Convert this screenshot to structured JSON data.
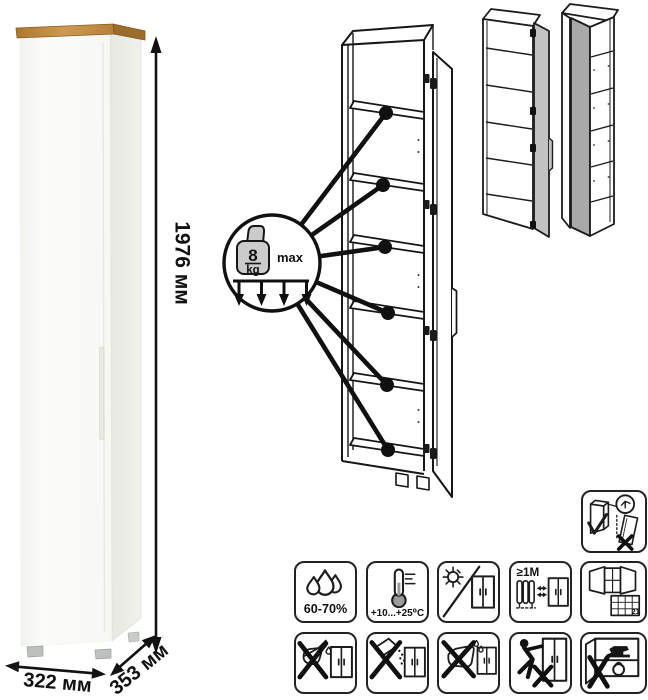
{
  "product": {
    "type": "tall one-door cabinet, white with wood top",
    "dimensions": {
      "height": "1976 мм",
      "width": "322 мм",
      "depth": "353 мм"
    }
  },
  "load_badge": {
    "value": "8",
    "unit": "kg",
    "max_label": "max",
    "shelf_count": 6
  },
  "care": {
    "humidity_label": "60-70%",
    "temperature_label": "+10...+25⁰C",
    "distance_label": "≥1М",
    "calendar_day": "21"
  },
  "icons": {
    "wall_mount": "anti-tip-wall-mount-icon",
    "row1": [
      "humidity-drops-icon",
      "thermometer-icon",
      "no-direct-sunlight-icon",
      "heat-distance-icon",
      "ventilation-calendar-icon"
    ],
    "row2": [
      "no-liquids-icon",
      "no-abrasive-powder-icon",
      "no-wet-cleaning-icon",
      "no-dragging-icon",
      "no-overload-icon"
    ]
  },
  "colors": {
    "wood_top": "#c08a3e",
    "cabinet_front": "#f9f9f6",
    "cabinet_side": "#ebecе7",
    "door_gray_left_variant": "#c2c2c2",
    "door_gray_right_variant": "#a9a9a9",
    "line_art": "#1c1c1c"
  }
}
